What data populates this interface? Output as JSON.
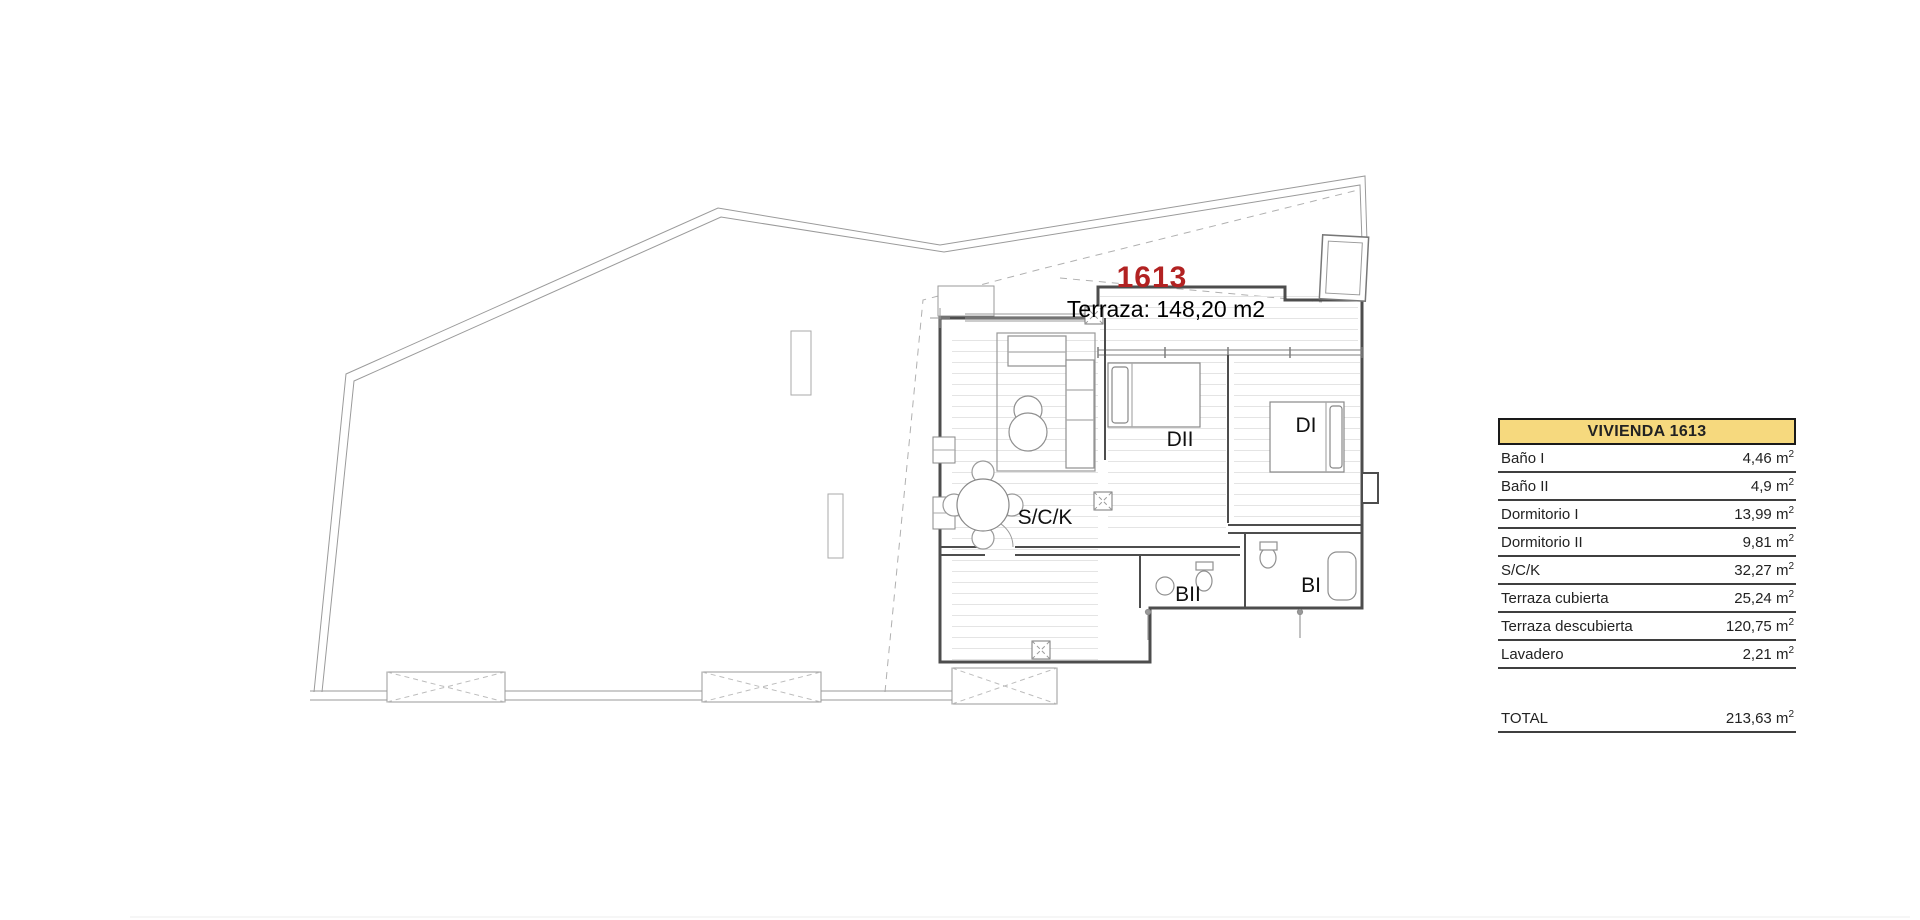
{
  "plan": {
    "unit_number": "1613",
    "terrace_label": "Terraza: 148,20 m2",
    "unit_number_color": "#b22222",
    "rooms": {
      "sck": "S/C/K",
      "dormitorio2": "DII",
      "dormitorio1": "DI",
      "bano2": "BII",
      "bano1": "BI"
    }
  },
  "table": {
    "title": "VIVIENDA 1613",
    "header_bg": "#f6d97e",
    "unit_base": "m",
    "unit_sup": "2",
    "rows": [
      {
        "label": "Baño I",
        "area": "4,46"
      },
      {
        "label": "Baño II",
        "area": "4,9"
      },
      {
        "label": "Dormitorio I",
        "area": "13,99"
      },
      {
        "label": "Dormitorio II",
        "area": "9,81"
      },
      {
        "label": "S/C/K",
        "area": "32,27"
      },
      {
        "label": "Terraza cubierta",
        "area": "25,24"
      },
      {
        "label": "Terraza descubierta",
        "area": "120,75"
      },
      {
        "label": "Lavadero",
        "area": "2,21"
      }
    ],
    "total": {
      "label": "TOTAL",
      "area": "213,63"
    }
  }
}
